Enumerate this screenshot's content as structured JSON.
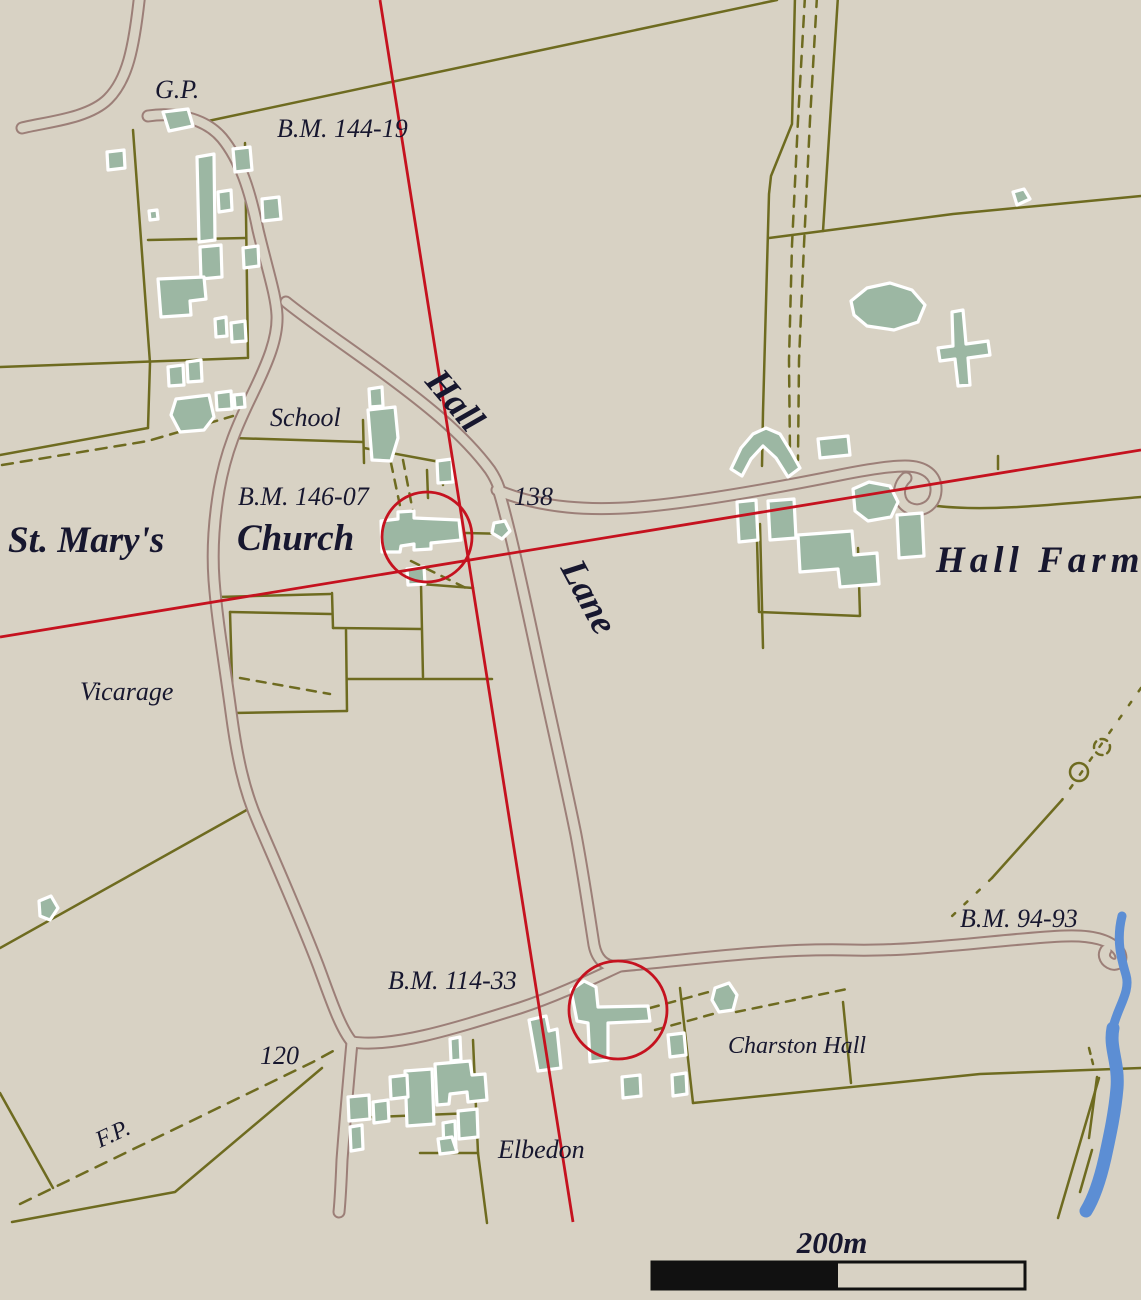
{
  "map": {
    "labels": {
      "gp": "G.P.",
      "bm_144_19": "B.M. 144-19",
      "school": "School",
      "hall": "Hall",
      "lane": "Lane",
      "bm_146_07": "B.M. 146-07",
      "st_marys": "St. Mary's",
      "church": "Church",
      "spot_height_138": "138",
      "hall_farm": "Hall Farm",
      "vicarage": "Vicarage",
      "bm_94_93": "B.M. 94-93",
      "bm_114_33": "B.M. 114-33",
      "charston_hall": "Charston Hall",
      "spot_height_120": "120",
      "footpath": "F.P.",
      "elbedon": "Elbedon"
    },
    "scale_bar": {
      "label": "200m"
    },
    "colors": {
      "background": "#d8d2c4",
      "road_casing": "#9c7f78",
      "field_boundary": "#6e6b20",
      "building_fill": "#9cb7a3",
      "building_outline": "#ffffff",
      "highlight_red": "#c5121f",
      "water_blue": "#5c8ed4",
      "label_text": "#17172f",
      "scale_bar_black": "#111111"
    }
  }
}
